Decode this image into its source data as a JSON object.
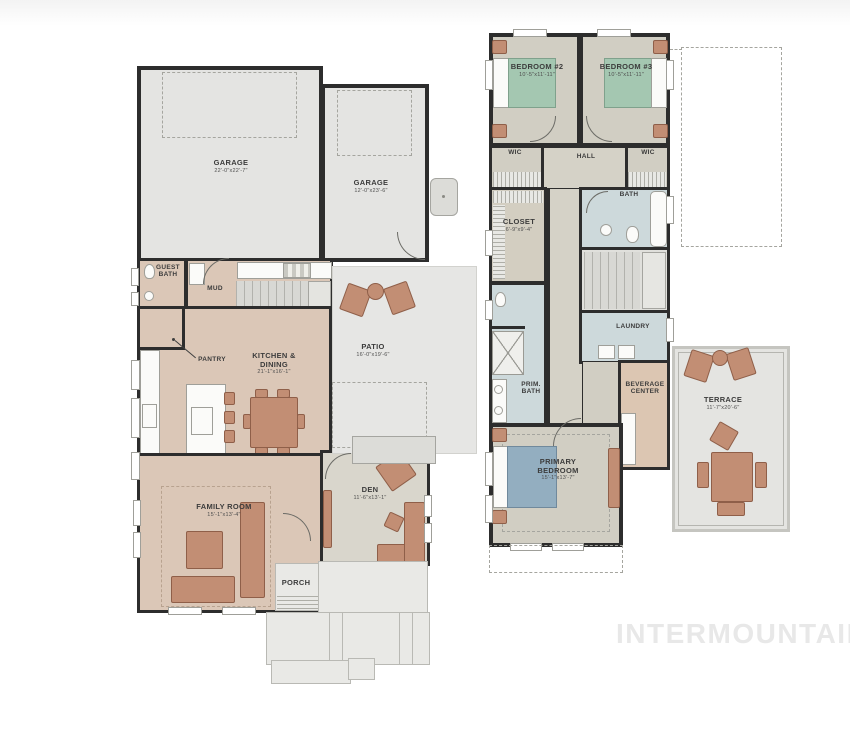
{
  "watermark": "INTERMOUNTAIN",
  "plan1": {
    "rooms": {
      "garage_main": {
        "label": "GARAGE",
        "dims": "22'-0\"x22'-7\""
      },
      "garage_single": {
        "label": "GARAGE",
        "dims": "12'-0\"x23'-6\""
      },
      "guest_bath": {
        "label": "GUEST BATH"
      },
      "mud": {
        "label": "MUD"
      },
      "pantry": {
        "label": "PANTRY"
      },
      "kitchen_dining": {
        "label": "KITCHEN & DINING",
        "dims": "21'-1\"x16'-1\""
      },
      "patio": {
        "label": "PATIO",
        "dims": "16'-0\"x19'-6\""
      },
      "family_room": {
        "label": "FAMILY ROOM",
        "dims": "15'-1\"x13'-4\""
      },
      "den": {
        "label": "DEN",
        "dims": "11'-6\"x13'-1\""
      },
      "porch": {
        "label": "PORCH"
      }
    }
  },
  "plan2": {
    "rooms": {
      "bedroom2": {
        "label": "BEDROOM #2",
        "dims": "10'-5\"x11'-11\""
      },
      "bedroom3": {
        "label": "BEDROOM #3",
        "dims": "10'-5\"x11'-11\""
      },
      "wic_left": {
        "label": "WIC"
      },
      "hall": {
        "label": "HALL"
      },
      "wic_right": {
        "label": "WIC"
      },
      "bath": {
        "label": "BATH"
      },
      "closet": {
        "label": "CLOSET",
        "dims": "6'-9\"x9'-4\""
      },
      "laundry": {
        "label": "LAUNDRY"
      },
      "prim_bath": {
        "label": "PRIM. BATH"
      },
      "beverage_center": {
        "label": "BEVERAGE CENTER"
      },
      "primary_bedroom": {
        "label": "PRIMARY BEDROOM",
        "dims": "15'-1\"x13'-7\""
      },
      "terrace": {
        "label": "TERRACE",
        "dims": "11'-7\"x20'-6\""
      }
    }
  },
  "colors": {
    "wall": "#2d2d2d",
    "floor_tan": "#dbc7b7",
    "floor_gray": "#e4e4e2",
    "floor_den": "#d9d6cc",
    "floor_neutral": "#d1cec3",
    "floor_bath": "#cdd9db",
    "floor_closet": "#d3cec1",
    "floor_beverage": "#dcc6b2",
    "furniture": "#c28e74",
    "bed_green": "#a4c7b1",
    "bed_blue": "#93aec0",
    "watermark_color": "#e8e8e8"
  }
}
